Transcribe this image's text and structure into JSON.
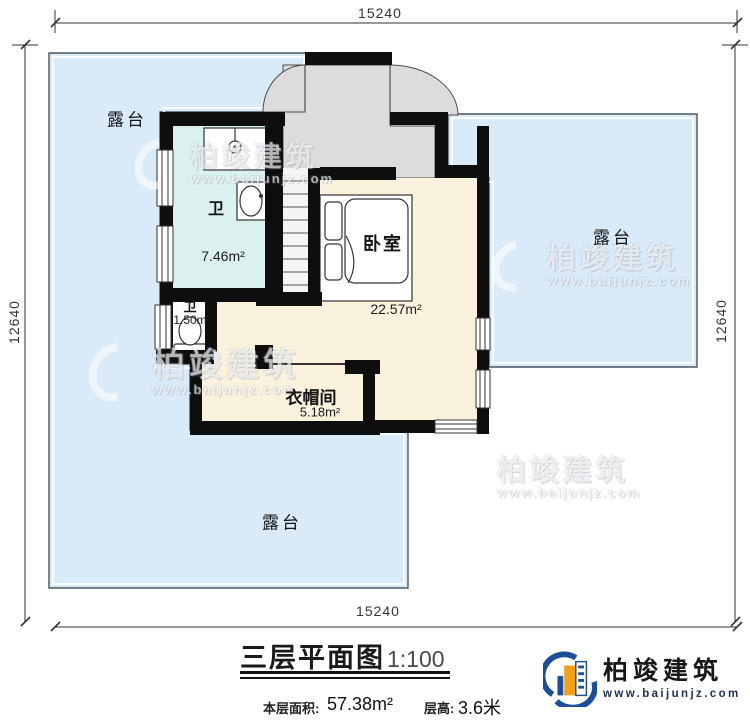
{
  "title": {
    "name": "三层平面图",
    "scale": "1:100"
  },
  "info": {
    "area_label": "本层面积:",
    "area_value": "57.38m²",
    "height_label": "层高:",
    "height_value": "3.6米"
  },
  "dimensions": {
    "top": "15240",
    "bottom": "15240",
    "left": "12640",
    "right": "12640"
  },
  "rooms": {
    "terrace_top": {
      "label": "露台"
    },
    "terrace_right": {
      "label": "露台"
    },
    "terrace_bottom": {
      "label": "露台"
    },
    "bathroom": {
      "label": "卫",
      "area": "7.46m²"
    },
    "bathroom_small": {
      "label": "卫",
      "area": "1.50m²"
    },
    "bedroom": {
      "label": "卧室",
      "area": "22.57m²"
    },
    "cloakroom": {
      "label": "衣帽间",
      "area": "5.18m²"
    }
  },
  "logo": {
    "company": "柏竣建筑",
    "website": "www.baijunjz.com"
  },
  "watermark": {
    "company": "柏竣建筑",
    "website": "www.baijunjz.com"
  },
  "colors": {
    "terrace": "#d9eaf8",
    "bathroom": "#daf1f0",
    "room": "#fbf2dd",
    "entry_gray": "#dcdcdc",
    "wall": "#0e0e0e",
    "accent_blue": "#1d4e9b",
    "accent_orange": "#f5a01a"
  }
}
